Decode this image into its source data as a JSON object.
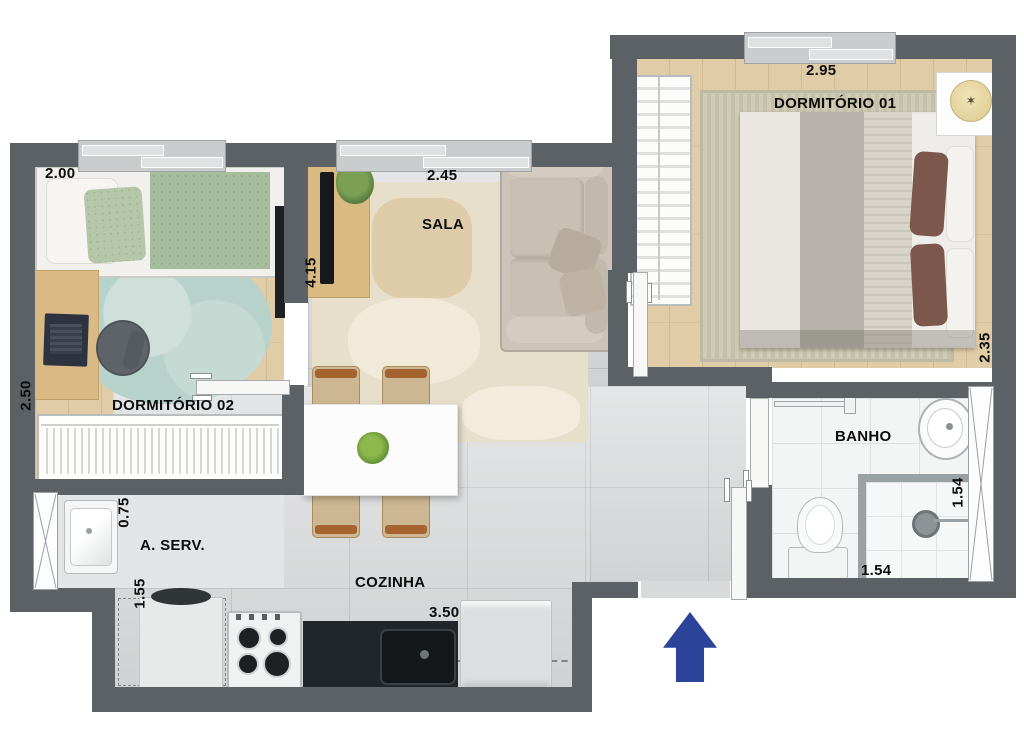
{
  "type": "apartment-floor-plan",
  "rooms": {
    "dormitorio01": {
      "label": "DORMITÓRIO 01",
      "dim_width": "2.95",
      "dim_height": "2.35"
    },
    "dormitorio02": {
      "label": "DORMITÓRIO 02",
      "dim_width": "2.00",
      "dim_height": "2.50"
    },
    "sala": {
      "label": "SALA",
      "dim_width": "2.45",
      "dim_height": "4.15"
    },
    "cozinha": {
      "label": "COZINHA",
      "dim_width": "3.50"
    },
    "area_servico": {
      "label": "A. SERV.",
      "dim_width": "0.75",
      "dim_height": "1.55"
    },
    "banho": {
      "label": "BANHO",
      "dim_width": "1.54",
      "dim_height": "1.54"
    }
  },
  "colors": {
    "wall": "#5c6165",
    "wood_floor": "#e0cca6",
    "tile_floor": "#d6d8d9",
    "bath_floor": "#f3f4f4",
    "entrance_arrow": "#2c439a"
  },
  "icons": {
    "entrance_arrow": "up-arrow",
    "ventilation_shaft": "x-cross"
  }
}
